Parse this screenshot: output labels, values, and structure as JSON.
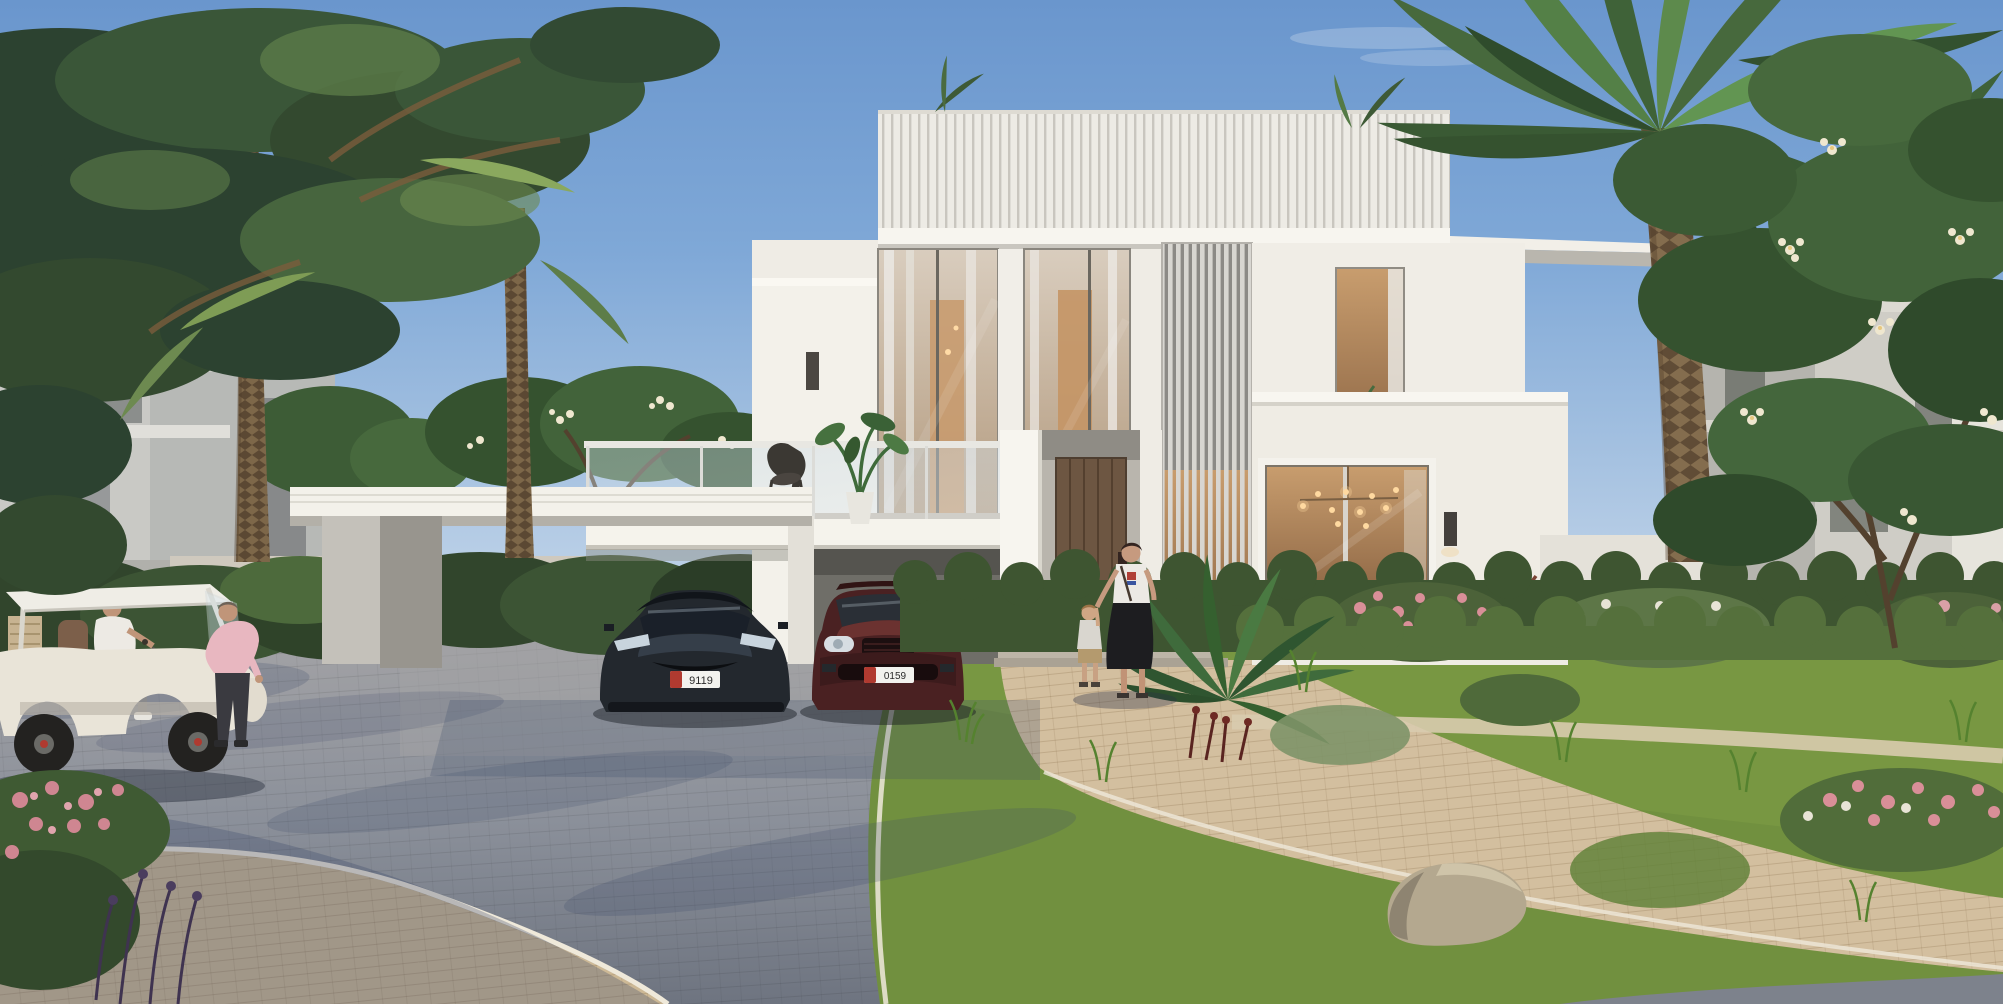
{
  "scene": {
    "title": "modern-villa-exterior-render",
    "width": 2003,
    "height": 1004
  },
  "villa": {
    "house_number": "17"
  },
  "vehicles": {
    "sedan_plate": "9119",
    "suv_plate": "0159",
    "plate_accent": "#b03a30"
  },
  "palette": {
    "sky_top": "#6a96cd",
    "sky_horizon": "#cddcec",
    "villa_white": "#f3f1ea",
    "villa_shade": "#dad7d0",
    "canopy_grey": "#c6c3bc",
    "road_grey": "#8b909a",
    "road_shadow": "#3c4a6a",
    "paver_beige": "#d3bf9f",
    "hedge_green": "#4c6239",
    "grass_green": "#71903f",
    "palm_green": "#486b3a",
    "trunk_brown": "#7d6749",
    "sedan_black": "#23282e",
    "suv_maroon": "#4a2122",
    "cart_cream": "#e9e4d8",
    "flower_pink": "#d98f98",
    "blossom_white": "#efe7cf",
    "warm_light": "#ffd9a0"
  }
}
